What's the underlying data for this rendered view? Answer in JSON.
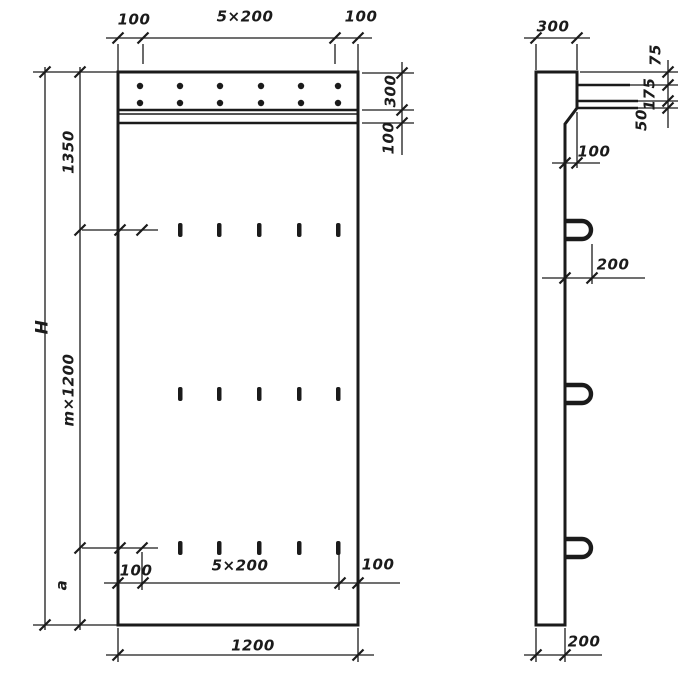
{
  "front": {
    "top": {
      "left": "100",
      "center": "5×200",
      "right": "100"
    },
    "right": {
      "strip": "300",
      "band": "100"
    },
    "left": {
      "overall": "H",
      "upper": "1350",
      "middle": "m×1200",
      "lower": "a"
    },
    "bottom": {
      "left": "100",
      "center": "5×200",
      "right": "100",
      "overall": "1200"
    }
  },
  "side": {
    "top": "300",
    "right": {
      "a": "75",
      "b": "175",
      "c": "50"
    },
    "step": "100",
    "loop": "200",
    "thickness": "200"
  },
  "colors": {
    "ink": "#1b1b1b",
    "paper": "#ffffff"
  }
}
